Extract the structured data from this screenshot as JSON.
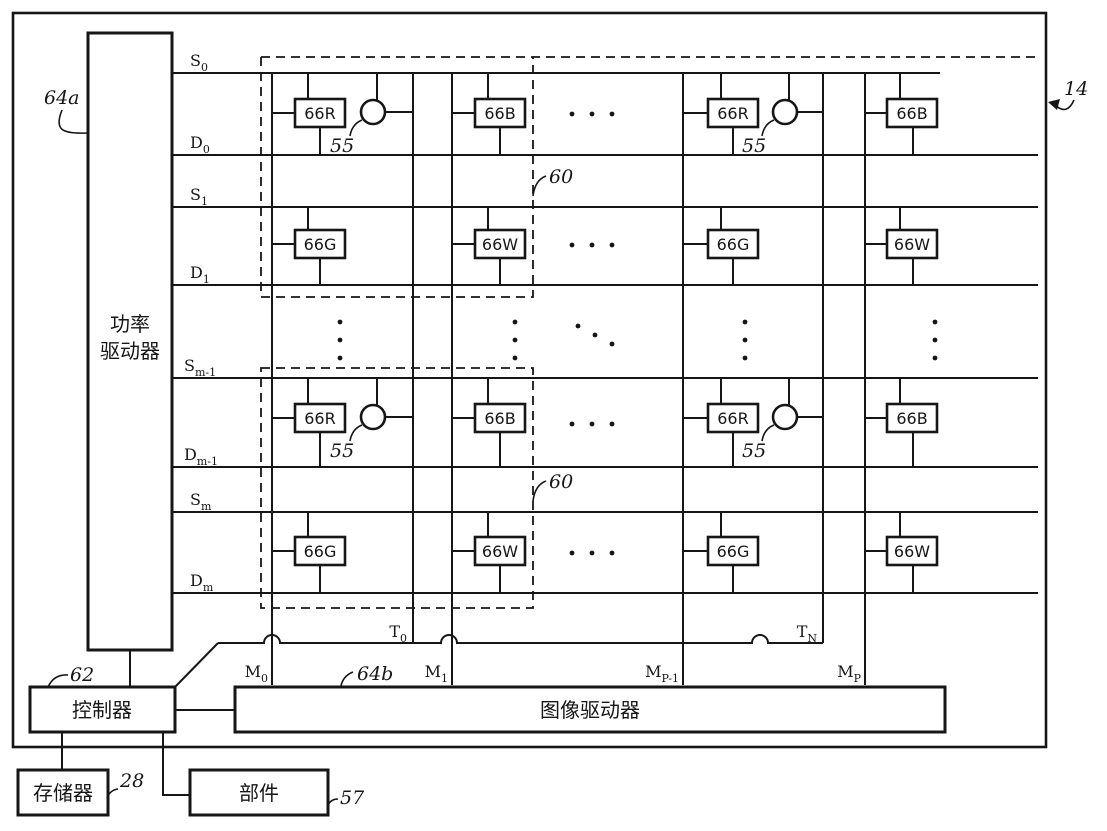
{
  "figure_ref": "14",
  "power_driver": {
    "label_line1": "功率",
    "label_line2": "驱动器",
    "ref": "64a"
  },
  "image_driver": {
    "label": "图像驱动器",
    "ref": "64b"
  },
  "controller": {
    "label": "控制器",
    "ref": "62"
  },
  "memory": {
    "label": "存储器",
    "ref": "28"
  },
  "component": {
    "label": "部件",
    "ref": "57"
  },
  "pixel_types": {
    "red": "66R",
    "green": "66G",
    "blue": "66B",
    "white": "66W"
  },
  "sensor_ref": "55",
  "group_ref": "60",
  "select_lines": [
    {
      "base": "S",
      "sub": "0"
    },
    {
      "base": "D",
      "sub": "0"
    },
    {
      "base": "S",
      "sub": "1"
    },
    {
      "base": "D",
      "sub": "1"
    },
    {
      "base": "S",
      "sub": "m-1"
    },
    {
      "base": "D",
      "sub": "m-1"
    },
    {
      "base": "S",
      "sub": "m"
    },
    {
      "base": "D",
      "sub": "m"
    }
  ],
  "column_lines": [
    {
      "base": "M",
      "sub": "0"
    },
    {
      "base": "M",
      "sub": "1"
    },
    {
      "base": "M",
      "sub": "P-1"
    },
    {
      "base": "M",
      "sub": "P"
    }
  ],
  "gate_lines": [
    {
      "base": "T",
      "sub": "0"
    },
    {
      "base": "T",
      "sub": "N"
    }
  ]
}
